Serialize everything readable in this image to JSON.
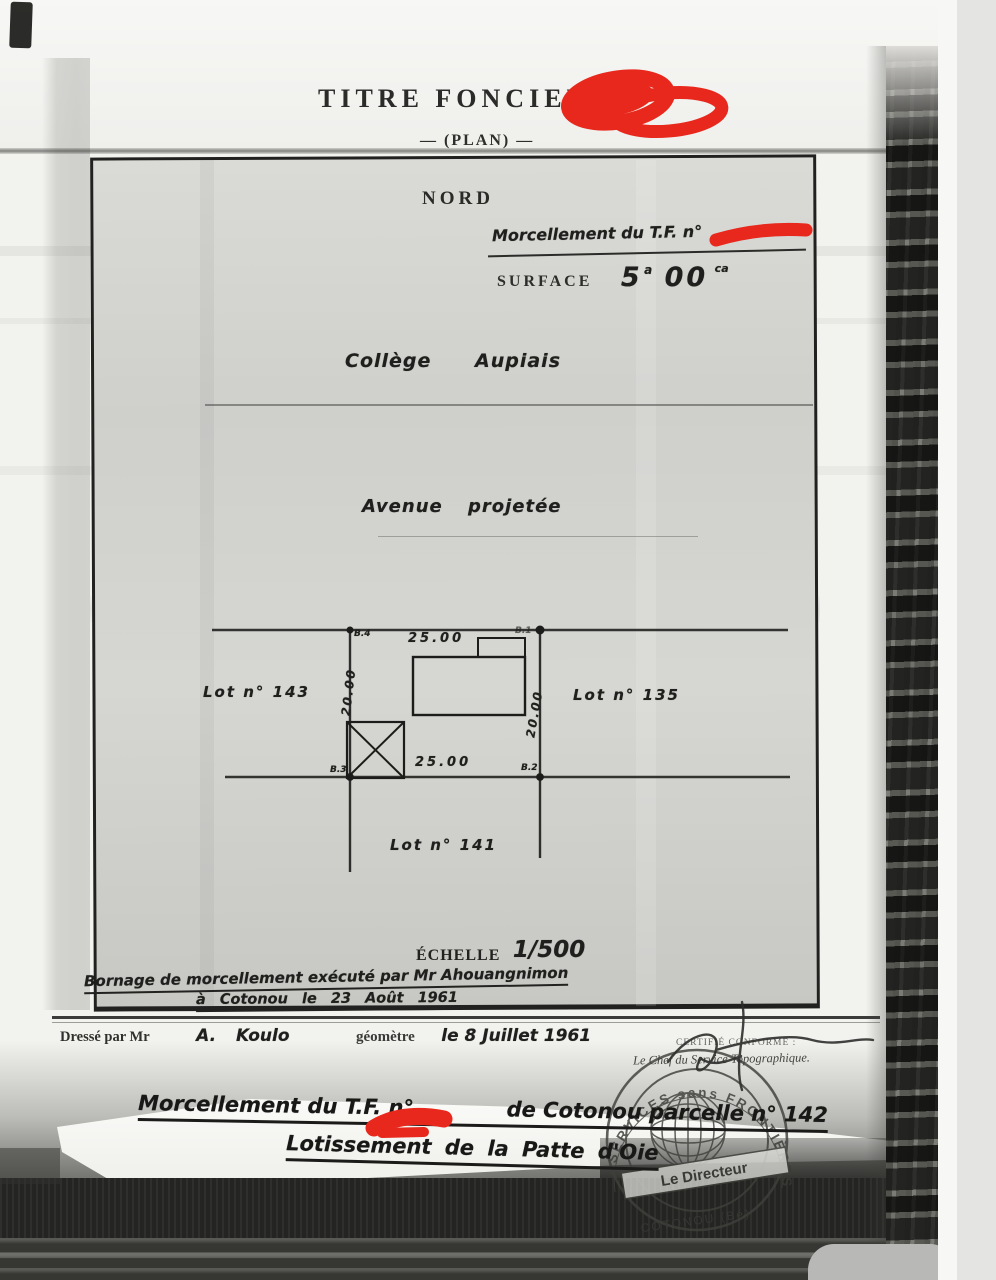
{
  "header": {
    "title": "TITRE FONCIER N°",
    "subtitle": "— (PLAN) —"
  },
  "plan": {
    "north": "NORD",
    "morcellement": "Morcellement du T.F. n°",
    "surface": {
      "label": "SURFACE",
      "ares": "5",
      "ares_unit": "a",
      "centiares": "00",
      "centiares_unit": "ca"
    },
    "college": "Collège Aupiais",
    "avenue": "Avenue projetée",
    "lots": [
      {
        "label": "Lot n° 143"
      },
      {
        "label": "Lot n° 135"
      },
      {
        "label": "Lot n° 141"
      }
    ],
    "dimensions": {
      "top": "25.00",
      "bottom": "25.00",
      "left": "20.00",
      "right": "20.00"
    },
    "markers": {
      "top_left": "B.4",
      "top_right": "B.1",
      "bottom_left": "B.3",
      "bottom_right": "B.2"
    },
    "scale": {
      "label": "ÉCHELLE",
      "value": "1/500"
    }
  },
  "annotations": {
    "bornage_line1": "Bornage de morcellement exécuté par Mr Ahouangnimon",
    "bornage_line2": "à Cotonou le 23 Août 1961",
    "dresse": {
      "prefix": "Dressé par Mr",
      "name": "A. Koulo",
      "role": "géomètre",
      "date": "le 8 Juillet 1961"
    },
    "certifie": "CERTIFIÉ CONFORME :",
    "chef": "Le Chef du Service Topographique.",
    "bottom_line1_start": "Morcellement du T.F. n°",
    "bottom_line1_end": "de Cotonou parcelle n° 142",
    "bottom_line2": "Lotissement de la Patte d'Oie"
  },
  "stamp": {
    "arc_top": "SERVICES sans FRONTIÈRES",
    "banner": "Le Directeur",
    "arc_bottom": "COTONOU (Bé)"
  },
  "colors": {
    "redaction_red": "#e8281c",
    "ink": "#1d1d1b",
    "paper": "#efefec"
  }
}
